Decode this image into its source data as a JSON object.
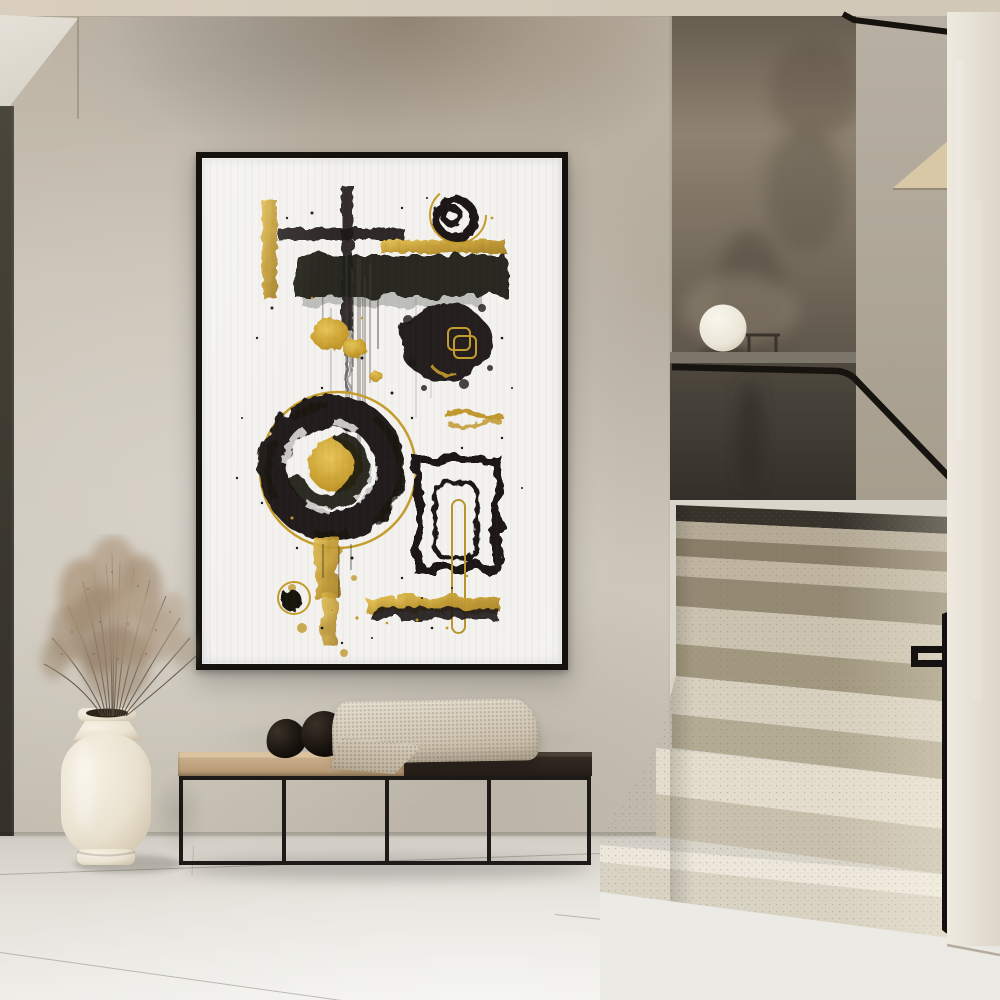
{
  "meta": {
    "type": "interior-photograph",
    "title": "Minimalist hallway with abstract wall art and staircase",
    "description": "Bright minimalist hallway: a large framed black-and-gold abstract grunge poster hangs on a textured greige plaster wall above a low black metal bench with a two-tone wooden seat, two black stone spheres and a cream knitted throw. A tall cream ceramic floor vase holds dried beige stems. To the right, terrazzo stairs with a black metal handrail climb past a dark taupe stairwell wall with a white globe lamp resting on the landing ledge."
  },
  "objects": {
    "poster": {
      "label": "Framed abstract art poster",
      "frame": "thin black metal frame",
      "style": "black ink brush strokes, splatters and spirals with gold foil accents on white"
    },
    "bench": {
      "label": "Low bench with thin black metal frame",
      "seat_left": "light oak seat",
      "seat_right": "dark walnut seat",
      "decor": [
        "small black stone sphere",
        "large black stone sphere",
        "cream knitted throw blanket"
      ]
    },
    "vase": {
      "label": "Cream ceramic floor vase",
      "contents": "dried beige gypsophila stems"
    },
    "stairs": {
      "label": "Terrazzo staircase turning up to the right",
      "handrail": "black metal handrail",
      "lamp": "white globe lamp on landing ledge",
      "side_table": "small thin-frame table on landing",
      "steps_visible": 7
    },
    "walls": {
      "main": "textured greige plaster wall",
      "stairwell": "dark taupe plaster wall",
      "right": "off-white plaster wall",
      "left_edge": "dark door reveal strip"
    },
    "floor": {
      "label": "large-format light stone tiles"
    },
    "ceiling": {
      "label": "warm beige ceiling strip"
    }
  },
  "palette": {
    "ceiling": "#d7cdbd",
    "wall_main": "#c8c1b4",
    "door_strip": "#3f3b31",
    "wedge": "#e0dcd2",
    "frame_black": "#15120e",
    "art_bg": "#f3f2ef",
    "art_black": "#1b1815",
    "art_gold": "#c2992e",
    "bench_wood": "#c9ad8a",
    "bench_dark_seat": "#2e2620",
    "metal_black": "#1d1a17",
    "blanket": "#d9d1c2",
    "pebble_black": "#17120d",
    "vase_cream": "#ebe4d5",
    "floor": "#dcd8cf",
    "floor_bright": "#ecebe6",
    "right_wall": "#e6e1d7",
    "rail_black": "#16130f",
    "stair_back_wall": "#6b6051",
    "parapet_dark": "#37332c",
    "step_light": "#ece8dd",
    "step_dark": "#968b74",
    "grass_taupe": "#a8937b"
  }
}
